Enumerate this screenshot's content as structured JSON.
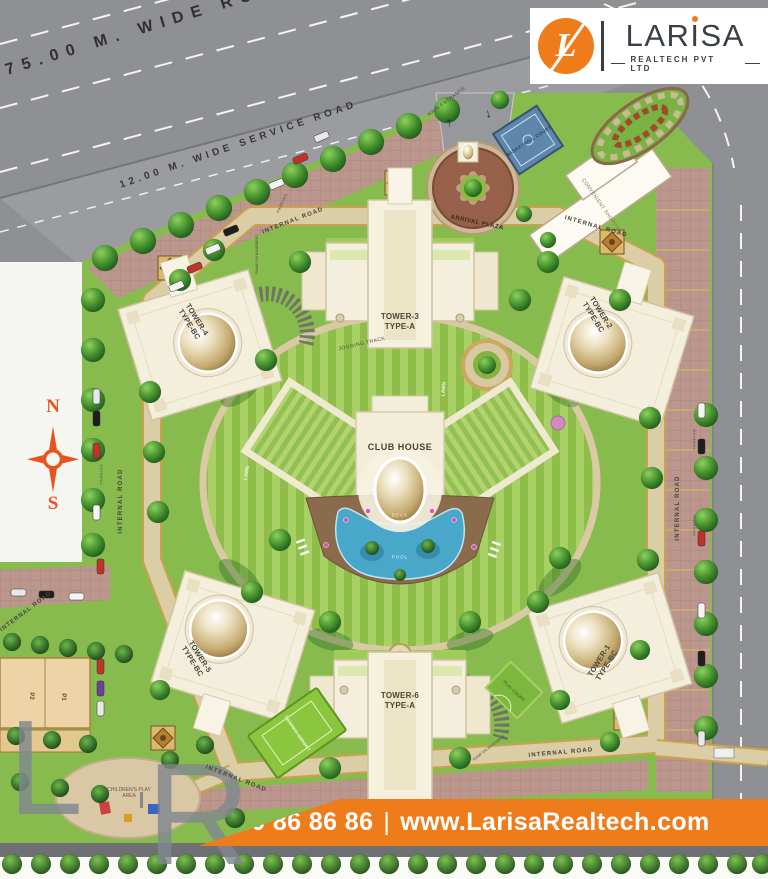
{
  "colors": {
    "brand_orange": "#ee7c1b",
    "road_gray": "#8f9094",
    "site_green": "#88bb4d",
    "compass_red": "#e8541d",
    "pool_blue": "#49a8ca"
  },
  "logo": {
    "monogram": "L",
    "name_pre": "LAR",
    "name_dot_letter": "I",
    "name_post": "SA",
    "subtitle": "REALTECH PVT LTD"
  },
  "roads": {
    "main_road": "75.00 M. WIDE ROAD",
    "service_road": "12.00 M. WIDE SERVICE ROAD",
    "internal_road": "INTERNAL ROAD",
    "main_entrance": "MAIN ENTRANCE",
    "parking": "PARKING",
    "ramp": "RAMP DN BASEMENT",
    "arrow_in": "↑",
    "arrow_out": "↓"
  },
  "site": {
    "towers": [
      {
        "name": "TOWER-1",
        "type": "TYPE-BC"
      },
      {
        "name": "TOWER-2",
        "type": "TYPE-BC"
      },
      {
        "name": "TOWER-3",
        "type": "TYPE-A"
      },
      {
        "name": "TOWER-4",
        "type": "TYPE-BC"
      },
      {
        "name": "TOWER-5",
        "type": "TYPE-BC"
      },
      {
        "name": "TOWER-6",
        "type": "TYPE-A"
      }
    ],
    "amenities": {
      "club_house": "CLUB HOUSE",
      "deck": "DECK",
      "pool": "POOL",
      "arrival_plaza": "ARRIVAL PLAZA",
      "basketball_court": "BASKETBALL COURT",
      "convenient_shopping": "CONVENIENT SHOPPING",
      "tennis_court": "TENNIS COURT",
      "play_court": "PLAY COURT",
      "childrens_play_area": "CHILDREN'S PLAY AREA",
      "jogging_track": "JOGGING TRACK",
      "lawn": "LAWN"
    },
    "blocks": {
      "p1": "P1",
      "p2": "P2"
    }
  },
  "compass": {
    "north": "N",
    "south": "S"
  },
  "watermark": {
    "letter_l": "L",
    "letter_r": "R"
  },
  "footer": {
    "phone": "8750 86 86 86",
    "separator": "|",
    "website": "www.LarisaRealtech.com"
  }
}
